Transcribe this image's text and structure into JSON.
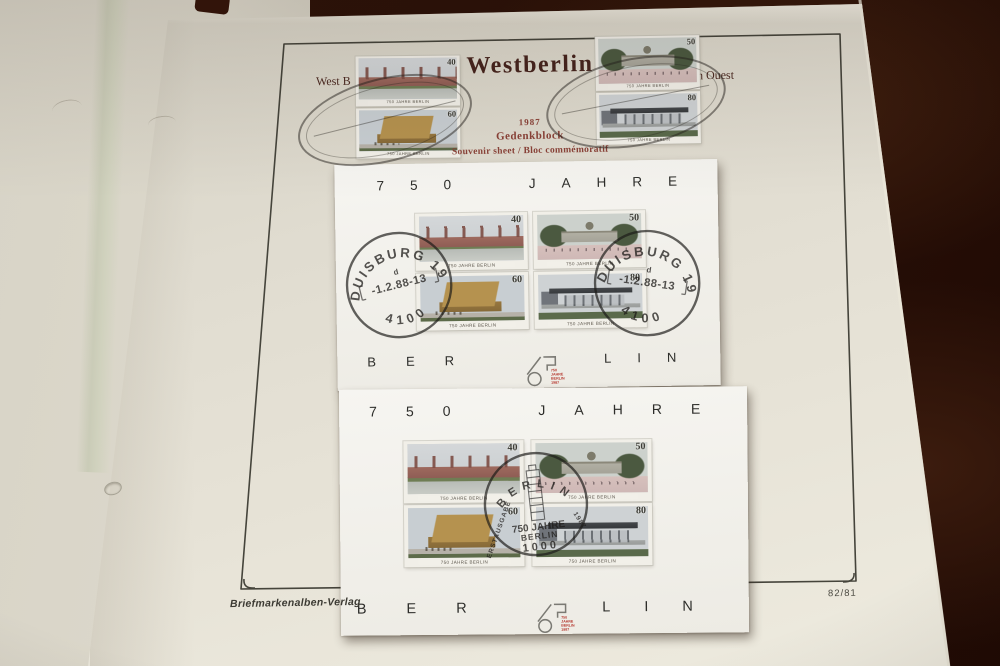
{
  "album_page": {
    "title": "Westberlin",
    "caption_left": "West B",
    "caption_right": "n Ouest",
    "year": "1987",
    "block_name": "Gedenkblock",
    "block_subtitle": "Souvenir sheet / Bloc commémoratif",
    "publisher": "Briefmarkenalben-Verlag",
    "page_number": "82/81"
  },
  "stamp_caption": "750 JAHRE BERLIN",
  "stamp_set": [
    {
      "value": "40",
      "subject": "old-city-panorama"
    },
    {
      "value": "50",
      "subject": "charlottenburg-palace"
    },
    {
      "value": "60",
      "subject": "concert-hall"
    },
    {
      "value": "80",
      "subject": "national-gallery"
    }
  ],
  "sheet": {
    "header": "750 JAHRE",
    "footer_left": "BER",
    "footer_right": "LIN",
    "logo": {
      "line1": "750",
      "line2": "JAHRE",
      "line3": "BERLIN",
      "line4": "1987"
    }
  },
  "postmarks": {
    "duisburg": {
      "town": "DUISBURG 19",
      "letter": "d",
      "date": "-1.2.88-13",
      "code": "4100"
    },
    "first_day": {
      "arc_top": "BERLIN",
      "arc_left": "ERSTAUSGABE",
      "arc_right": "1987",
      "line1": "750 JAHRE",
      "line2": "BERLIN",
      "line3": "1000"
    }
  },
  "colors": {
    "background": "#2a1007",
    "page": "#e2ded2",
    "sheet": "#f4f3ef",
    "accent_red": "#b5372e",
    "title": "#46241d"
  }
}
